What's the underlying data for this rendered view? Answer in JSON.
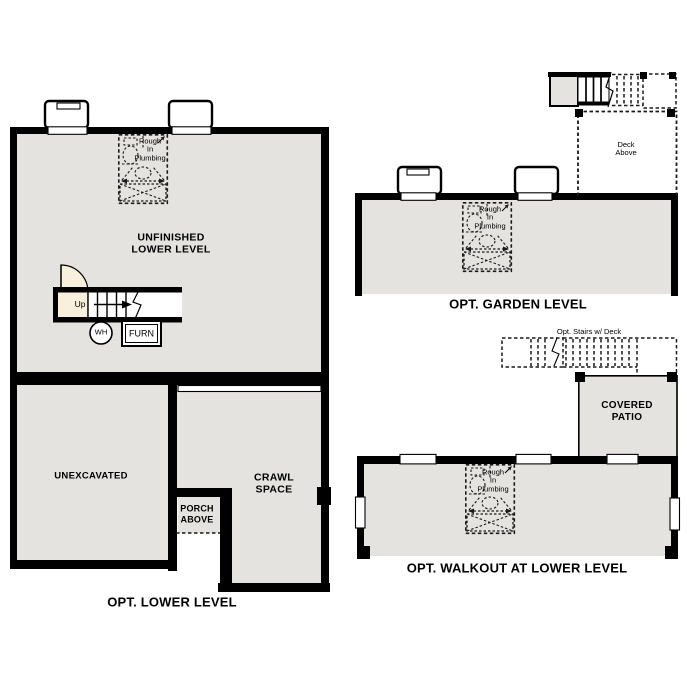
{
  "colors": {
    "room_fill": "#e4e3e0",
    "wall": "#000000",
    "door_fill": "#f8f0dc",
    "line": "#1a1a1a"
  },
  "lower_level": {
    "caption": "OPT. LOWER LEVEL",
    "unfinished_label": [
      "UNFINISHED",
      "LOWER LEVEL"
    ],
    "unexcavated_label": "UNEXCAVATED",
    "crawl_label": [
      "CRAWL",
      "SPACE"
    ],
    "porch_label": [
      "PORCH",
      "ABOVE"
    ],
    "up_label": "Up",
    "water_heater_label": "WH",
    "furnace_label": "FURN"
  },
  "garden_level": {
    "caption": "OPT. GARDEN LEVEL",
    "deck_label": [
      "Deck",
      "Above"
    ]
  },
  "walkout_level": {
    "caption": "OPT. WALKOUT AT LOWER LEVEL",
    "stairs_label": "Opt. Stairs w/ Deck",
    "patio_label": [
      "COVERED",
      "PATIO"
    ]
  },
  "plumbing_note": [
    "Rough",
    "In",
    "Plumbing"
  ]
}
